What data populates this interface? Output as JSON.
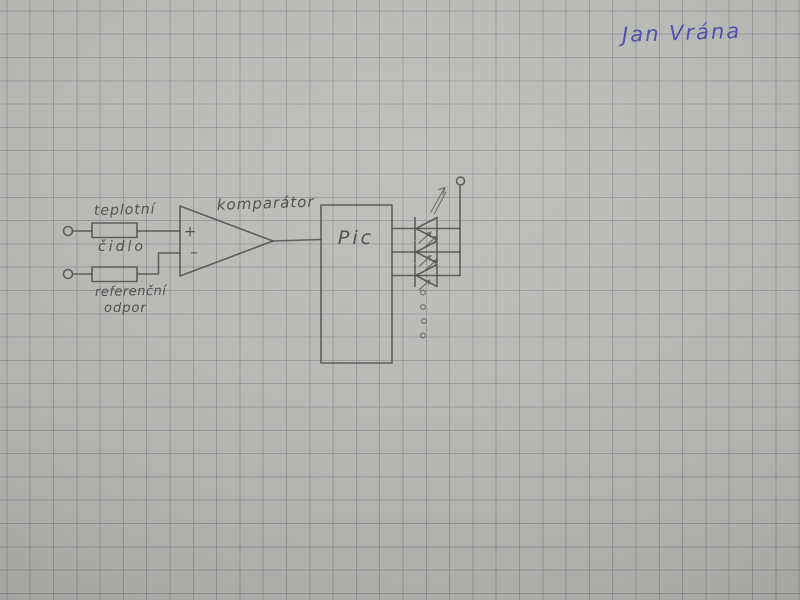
{
  "signature": {
    "text": "Jan Vrána",
    "ink_color": "#4747a9"
  },
  "paper": {
    "base_color": "#b6b7b2",
    "grid_color": "#767d8b",
    "grid_spacing_px": 23.3
  },
  "diagram": {
    "pencil_color": "#4b4b48",
    "components": {
      "temp_sensor": {
        "type": "resistor",
        "label_top": "teplotní",
        "label_bottom": "čidlo"
      },
      "reference_resistor": {
        "type": "resistor",
        "label_top": "referenční",
        "label_bottom": "odpor"
      },
      "comparator": {
        "label": "komparátor",
        "plus": "+",
        "minus": "–"
      },
      "pic": {
        "label": "Pic"
      },
      "leds": {
        "symbols_drawn": 3,
        "continuation_dots": 4
      }
    }
  }
}
